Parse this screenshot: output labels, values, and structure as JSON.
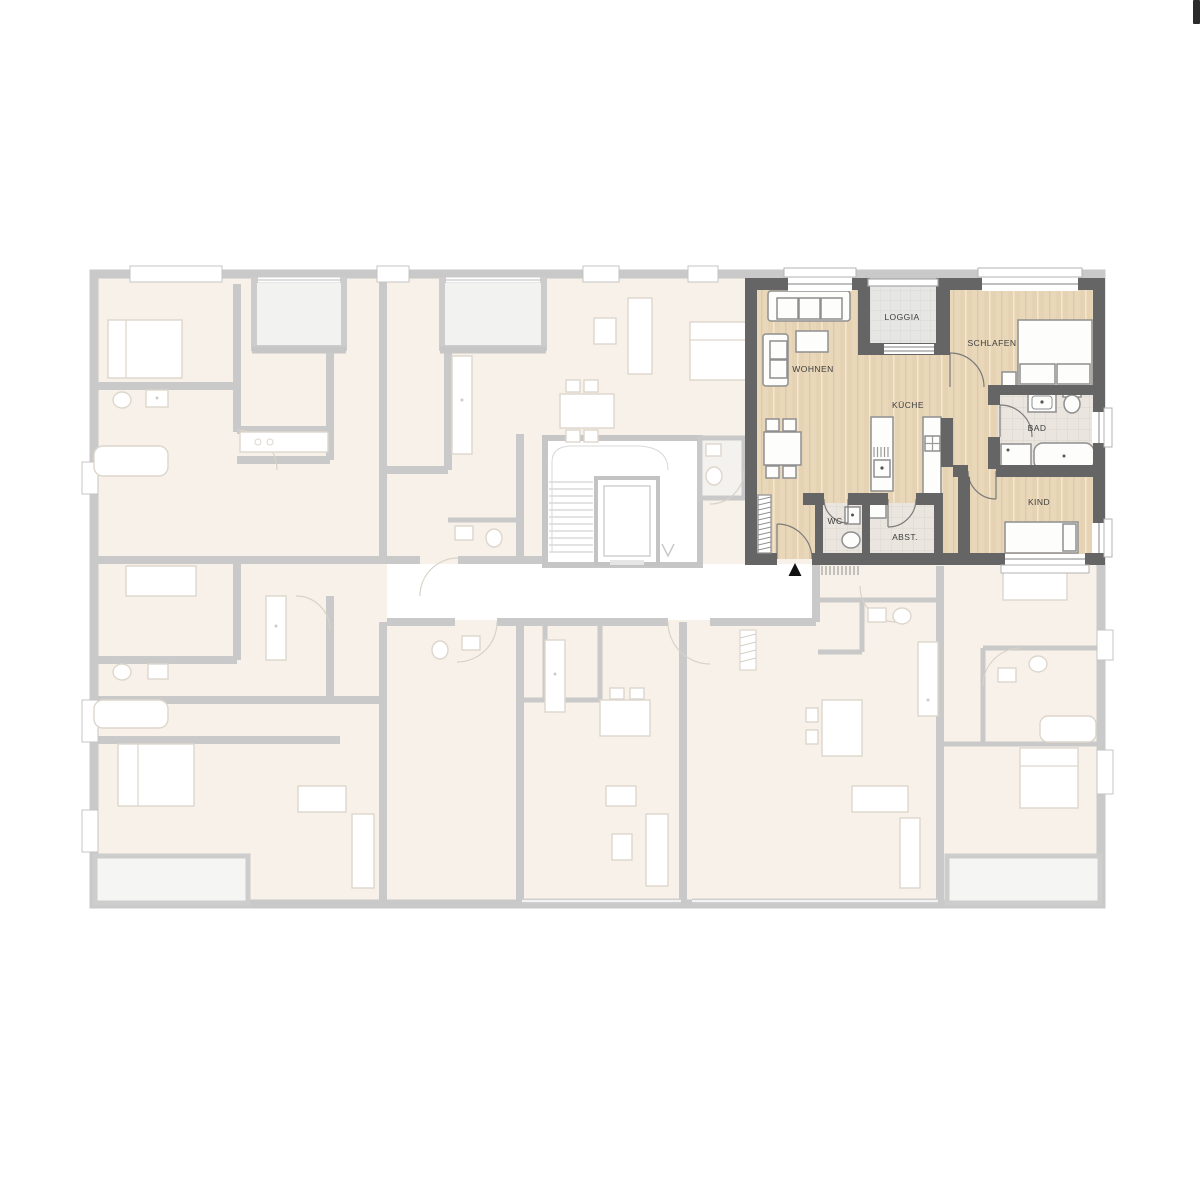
{
  "image": {
    "type": "architectural-floor-plan",
    "description": "Building floor plan with one highlighted apartment (top right), remaining apartments faded",
    "background": "#ffffff"
  },
  "highlighted_apartment": {
    "rooms": [
      {
        "id": "wohnen",
        "label": "WOHNEN"
      },
      {
        "id": "loggia",
        "label": "LOGGIA"
      },
      {
        "id": "schlafen",
        "label": "SCHLAFEN"
      },
      {
        "id": "kueche",
        "label": "KÜCHE"
      },
      {
        "id": "bad",
        "label": "BAD"
      },
      {
        "id": "kind",
        "label": "KIND"
      },
      {
        "id": "wc",
        "label": "WC"
      },
      {
        "id": "abst",
        "label": "ABST."
      }
    ],
    "entrance_marker": "▲",
    "colors": {
      "walls": "#656565",
      "wood_floor": "#e9d7ba",
      "bath_floor": "#eae6df",
      "loggia_floor": "#e6e6e4",
      "label_text": "#3d3d3d"
    }
  },
  "background_plan": {
    "style": "faded",
    "colors": {
      "walls": "#c9c9c9",
      "floor": "#f8f1e9",
      "corridor": "#ffffff",
      "furniture_stroke": "#ddd6cc"
    },
    "features": [
      "stairwell-with-elevator",
      "corridor",
      "loggias",
      "balconies",
      "neighbor-apartments"
    ]
  },
  "corner_mark": {
    "color": "#2b2b2b"
  }
}
